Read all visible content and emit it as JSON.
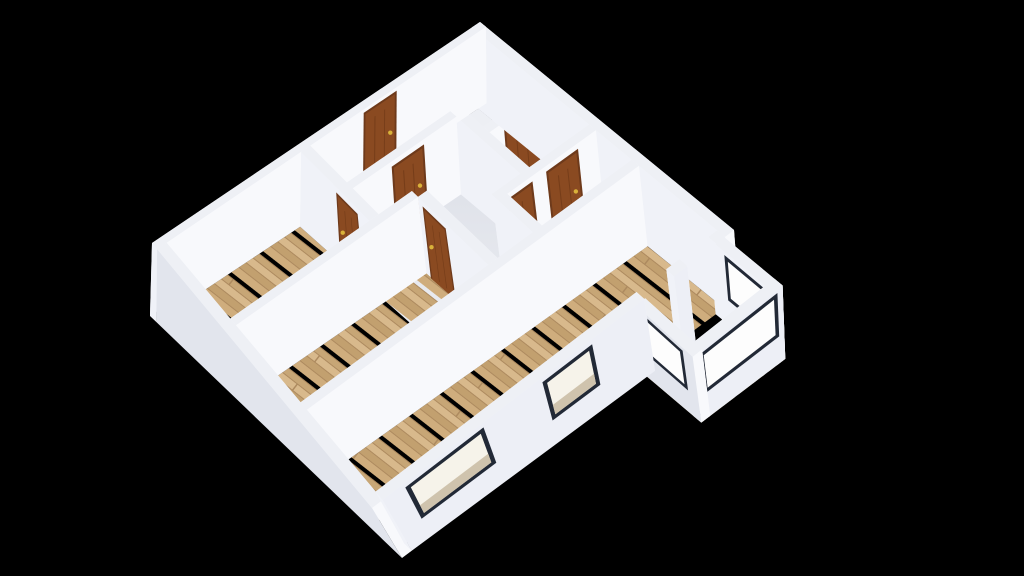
{
  "scene": {
    "description": "3d-floorplan-dollhouse-render",
    "canvas": {
      "width": 1024,
      "height": 576,
      "background": "#000000"
    },
    "plan_size_m": 10.4,
    "wall_height_m": 2.2,
    "projection": {
      "ground_corners": [
        [
          480,
          98
        ],
        [
          740,
          308
        ],
        [
          402,
          558
        ],
        [
          150,
          316
        ]
      ],
      "top_corners": [
        [
          480,
          22
        ],
        [
          734,
          230
        ],
        [
          372,
          508
        ],
        [
          152,
          243
        ]
      ]
    },
    "colors": {
      "face_px": "#f8f9fc",
      "face_py": "#f0f2f8",
      "face_nx": "#f2f3f7",
      "face_ny": "#f5f6f9",
      "top": "#eef0f5",
      "hall_floor_near": "#eef0f4",
      "hall_floor_far": "#d9dce5",
      "bath_floor": "#edeff4",
      "closet_floor": "#e9ebf1",
      "door_frame": "#6e3a1b",
      "door_panel": "#8a4a21",
      "door_groove": "rgba(60,25,5,0.25)",
      "door_handle": "#d9b23a",
      "window_frame": "#222936",
      "window_glass": "#f6f3ea",
      "window_sill": "#cfc3ad",
      "bay_glass": "#fdfdfd",
      "wood_seam": "#ad8a5f",
      "wood_planks": [
        "#cfad7d",
        "#c2a06f",
        "#d8b98c",
        "#c7a676"
      ],
      "wood_light_planks": [
        "#dfcaa3",
        "#d5bd92",
        "#e6d3ae",
        "#d9c298"
      ]
    }
  },
  "floors": [
    {
      "name": "floor-hallway",
      "rect": [
        0.28,
        0.28,
        7.2,
        6.0
      ],
      "material": "shaded"
    },
    {
      "name": "floor-bathroom-1",
      "rect": [
        0.28,
        0.28,
        3.2,
        2.2
      ],
      "material": "plain",
      "color": "#edeff4"
    },
    {
      "name": "floor-bathroom-2",
      "rect": [
        3.48,
        0.28,
        5.2,
        2.2
      ],
      "material": "plain",
      "color": "#edeff4"
    },
    {
      "name": "floor-closet",
      "rect": [
        0.28,
        2.48,
        2.1,
        5.75
      ],
      "material": "plain",
      "color": "#e9ebf1"
    },
    {
      "name": "floor-room-left",
      "rect": [
        0.28,
        6.03,
        3.6,
        10.12
      ],
      "material": "wood"
    },
    {
      "name": "floor-room-middle",
      "rect": [
        3.88,
        4.73,
        6.92,
        10.12
      ],
      "material": "wood"
    },
    {
      "name": "floor-room-right",
      "rect": [
        7.2,
        0.28,
        10.12,
        10.12
      ],
      "material": "wood"
    },
    {
      "name": "floor-bay",
      "rect": [
        10.4,
        0.3,
        12.4,
        3.0
      ],
      "material": "wood-light"
    }
  ],
  "walls": [
    {
      "name": "wall-outer-north",
      "rect": [
        0,
        0,
        10.4,
        0.28
      ]
    },
    {
      "name": "wall-outer-west",
      "rect": [
        0,
        0,
        0.28,
        10.4
      ]
    },
    {
      "name": "wall-outer-south",
      "rect": [
        0.28,
        10.12,
        10.4,
        10.4
      ],
      "face_py": "#e2e5ed"
    },
    {
      "name": "wall-outer-east-seg1",
      "rect": [
        10.12,
        0.28,
        10.4,
        0.55
      ],
      "face_px": "#edeff6"
    },
    {
      "name": "wall-outer-east-pillar",
      "rect": [
        10.12,
        1.45,
        10.4,
        1.85
      ],
      "face_px": "#edeff6"
    },
    {
      "name": "wall-outer-east-seg2",
      "rect": [
        10.12,
        2.75,
        10.4,
        10.12
      ],
      "face_px": "#edeff6"
    },
    {
      "name": "wall-bay-northeast",
      "rect": [
        10.4,
        0.3,
        12.4,
        0.58
      ]
    },
    {
      "name": "wall-bay-east",
      "rect": [
        12.12,
        0.3,
        12.4,
        3.0
      ],
      "face_px": "#edeff6"
    },
    {
      "name": "wall-bay-southwest",
      "rect": [
        10.4,
        2.72,
        12.4,
        3.0
      ],
      "face_py": "#e2e5ed"
    },
    {
      "name": "wall-bath-south",
      "rect": [
        0.28,
        2.2,
        5.2,
        2.48
      ]
    },
    {
      "name": "wall-bath-divider",
      "rect": [
        3.2,
        0.28,
        3.48,
        2.2
      ]
    },
    {
      "name": "wall-nook-west",
      "rect": [
        5.2,
        0.28,
        5.48,
        3.38
      ]
    },
    {
      "name": "wall-nook-south",
      "rect": [
        5.48,
        3.1,
        6.92,
        3.38
      ]
    },
    {
      "name": "wall-closet-east",
      "rect": [
        2.1,
        2.48,
        2.38,
        5.75
      ]
    },
    {
      "name": "wall-hall-room-left",
      "rect": [
        0.28,
        5.75,
        3.6,
        6.03
      ]
    },
    {
      "name": "wall-hall-room-middle",
      "rect": [
        3.88,
        4.45,
        6.92,
        4.73
      ]
    },
    {
      "name": "wall-left-middle-div",
      "rect": [
        3.6,
        4.73,
        3.88,
        10.12
      ]
    },
    {
      "name": "wall-middle-right-div",
      "rect": [
        6.92,
        0.28,
        7.2,
        10.12
      ]
    }
  ],
  "doors": [
    {
      "name": "door-entrance",
      "wall": "wall-outer-west",
      "face": "+x",
      "range": [
        3.05,
        4.0
      ],
      "height": 2.05
    },
    {
      "name": "door-bathroom-2",
      "wall": "wall-bath-divider",
      "face": "+x",
      "range": [
        0.75,
        1.7
      ],
      "height": 2.0
    },
    {
      "name": "door-nook-north",
      "wall": "wall-nook-west",
      "face": "+x",
      "range": [
        0.95,
        1.85
      ],
      "height": 2.0
    },
    {
      "name": "door-nook-south",
      "wall": "wall-nook-west",
      "face": "+x",
      "range": [
        2.4,
        3.3
      ],
      "height": 2.0
    },
    {
      "name": "door-room-left",
      "wall": "wall-hall-room-left",
      "face": "+y",
      "range": [
        2.1,
        3.0
      ],
      "height": 2.0
    },
    {
      "name": "door-room-middle",
      "wall": "wall-hall-room-middle",
      "face": "+y",
      "range": [
        4.15,
        5.05
      ],
      "height": 2.0
    },
    {
      "name": "door-closet",
      "wall": "wall-closet-east",
      "face": "+x",
      "range": [
        3.6,
        4.5
      ],
      "height": 2.0
    }
  ],
  "windows": [
    {
      "name": "window-se-large",
      "wall": "wall-outer-east-seg2",
      "face": "+x",
      "range": [
        7.5,
        9.5
      ],
      "z": [
        0.85,
        2.0
      ],
      "glass": "#f6f3ea",
      "sill": true
    },
    {
      "name": "window-se-medium",
      "wall": "wall-outer-east-seg2",
      "face": "+x",
      "range": [
        4.4,
        5.7
      ],
      "z": [
        0.85,
        2.0
      ],
      "glass": "#f6f3ea",
      "sill": true
    },
    {
      "name": "window-bay-southwest",
      "wall": "wall-bay-southwest",
      "face": "+y",
      "range": [
        10.75,
        12.0
      ],
      "z": [
        0.9,
        2.05
      ],
      "glass": "#fdfdfd",
      "sill": false
    },
    {
      "name": "window-bay-east",
      "wall": "wall-bay-east",
      "face": "+x",
      "range": [
        0.55,
        2.75
      ],
      "z": [
        0.9,
        2.05
      ],
      "glass": "#fdfdfd",
      "sill": false
    },
    {
      "name": "window-bay-northeast",
      "wall": "wall-bay-northeast",
      "face": "+y",
      "range": [
        10.8,
        12.05
      ],
      "z": [
        0.9,
        2.05
      ],
      "glass": "#fdfdfd",
      "sill": false
    }
  ]
}
